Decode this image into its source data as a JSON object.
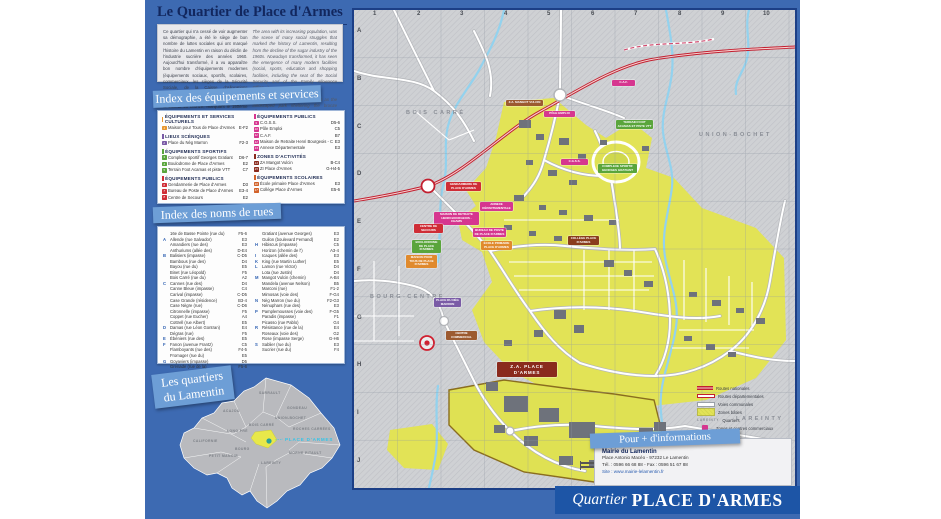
{
  "poster": {
    "title": "Le Quartier de Place d'Armes"
  },
  "intro": {
    "fr": "Ce quartier qui n'a cessé de voir augmenter sa démographie, a été le siège de bon nombre de luttes sociales qui ont marqué l'histoire du Lamentin en raison du déclin de l'industrie sucrière des années 1960. Aujourd'hui transformé, il a vu apparaître bon nombre d'équipements modernes (équipements sociaux, sportifs, scolaires, commerciaux, les sièges de la Sécurité Sociale, de la Caisse d'Allocations Familiales...). On peut y découvrir des sites tels qu'un parc paysager abritant l'Arbre de la Liberté en bronze, marquant le 150ème anniversaire de l'abolition de l'esclavage, la fresque murale du Canal Martin, un centre commercial...",
    "en1": "The area with its increasing population, was the scene of many social struggles that marked the history of Lamentin, resulting from the decline of the sugar industry of the 1960s. Nowadays transformed, it has seen the emergence of many modern facilities (social, sports, education and shopping facilities, including the seat of the Social Security and of the Family Allowance Office...).",
    "en2": "Here can be discovered such sites as the landscaped park sheltering the bronze Liberty Tree, inaugurated for the 150th anniversary of the abolition of slavery, the Canal Martin mural and a shopping centre..."
  },
  "banners": {
    "equip": "Index des équipements et services",
    "rues": "Index des noms de rues",
    "quartiers_1": "Les quartiers",
    "quartiers_2": "du Lamentin"
  },
  "equip": {
    "sections": [
      {
        "title": "ÉQUIPEMENTS ET SERVICES CULTURELS",
        "items": [
          {
            "n": "1",
            "name": "Maison pour Tous de Place d'Armes",
            "ref": "E-F2"
          }
        ]
      },
      {
        "title": "LIEUX SCÉNIQUES",
        "items": [
          {
            "n": "2",
            "name": "Place du Nèg Marron",
            "ref": "F2-3"
          }
        ]
      },
      {
        "title": "ÉQUIPEMENTS SPORTIFS",
        "items": [
          {
            "n": "3",
            "name": "Complexe sportif Georges Gratiant",
            "ref": "D6-7"
          },
          {
            "n": "4",
            "name": "Boulodrome de Place d'Armes",
            "ref": "E2"
          },
          {
            "n": "5",
            "name": "Terrain Foot Acamas et piste VTT",
            "ref": "C7"
          }
        ]
      },
      {
        "title": "ÉQUIPEMENTS PUBLICS",
        "items": [
          {
            "n": "6",
            "name": "Gendarmerie de Place d'Armes",
            "ref": "D3"
          },
          {
            "n": "7",
            "name": "Bureau de Poste de Place d'Armes",
            "ref": "E3-4"
          },
          {
            "n": "8",
            "name": "Centre de Secours",
            "ref": "E2"
          }
        ]
      },
      {
        "title": "ÉQUIPEMENTS PUBLICS",
        "items": [
          {
            "n": "9",
            "name": "C.G.S.S.",
            "ref": "D5-6"
          },
          {
            "n": "10",
            "name": "Pôle Emploi",
            "ref": "C5"
          },
          {
            "n": "11",
            "name": "C.A.F.",
            "ref": "B7"
          },
          {
            "n": "12",
            "name": "Maison de Retraite Henri Bourgeois - CHAMS",
            "ref": "E3"
          },
          {
            "n": "13",
            "name": "Annexe Départementale",
            "ref": "E3"
          }
        ]
      },
      {
        "title": "ZONES D'ACTIVITÉS",
        "items": [
          {
            "n": "14",
            "name": "ZA Mangot Vulcin",
            "ref": "B-C4"
          },
          {
            "n": "15",
            "name": "ZI Place d'Armes",
            "ref": "G-H4-5"
          }
        ]
      },
      {
        "title": "ÉQUIPEMENTS SCOLAIRES",
        "items": [
          {
            "n": "16",
            "name": "École primaire Place d'Armes",
            "ref": "E3"
          },
          {
            "n": "17",
            "name": "Collège Place d'Armes",
            "ref": "E5-6"
          }
        ]
      }
    ]
  },
  "streets": {
    "col1": [
      {
        "letter": "",
        "name": "16e de Basse Pointe (rue du)",
        "ref": "F5-6"
      },
      {
        "letter": "A",
        "name": "Allende (rue Salvador)",
        "ref": "E3"
      },
      {
        "letter": "",
        "name": "Amandiers (rue des)",
        "ref": "E3"
      },
      {
        "letter": "",
        "name": "Anthuriums (allée des)",
        "ref": "D-E4"
      },
      {
        "letter": "B",
        "name": "Balisiers (impasse)",
        "ref": "C-D5"
      },
      {
        "letter": "",
        "name": "Bambous (rue des)",
        "ref": "D4"
      },
      {
        "letter": "",
        "name": "Bayou (rue du)",
        "ref": "E5"
      },
      {
        "letter": "",
        "name": "Binet (rue Léopold)",
        "ref": "F5"
      },
      {
        "letter": "",
        "name": "Bois Carré (rue du)",
        "ref": "A2"
      },
      {
        "letter": "C",
        "name": "Cannes (rue des)",
        "ref": "D4"
      },
      {
        "letter": "",
        "name": "Canne Bleue (impasse)",
        "ref": "C4"
      },
      {
        "letter": "",
        "name": "Carival (impasse)",
        "ref": "C-D5"
      },
      {
        "letter": "",
        "name": "Case Grande (résidence)",
        "ref": "B3-4"
      },
      {
        "letter": "",
        "name": "Case Nègre (rue)",
        "ref": "C-D6"
      },
      {
        "letter": "",
        "name": "Citronnelle (impasse)",
        "ref": "F5"
      },
      {
        "letter": "",
        "name": "Coppet (rue Eucher)",
        "ref": "A4"
      },
      {
        "letter": "",
        "name": "Cottrell (rue Albert)",
        "ref": "E5"
      },
      {
        "letter": "D",
        "name": "Damas (rue Léon Gontran)",
        "ref": "E4"
      },
      {
        "letter": "",
        "name": "Dégras (rue)",
        "ref": "F5"
      },
      {
        "letter": "E",
        "name": "Ébéniers (rue des)",
        "ref": "E5"
      },
      {
        "letter": "F",
        "name": "Fanon (avenue Frantz)",
        "ref": "C5"
      },
      {
        "letter": "",
        "name": "Flamboyants (rue des)",
        "ref": "F4-5"
      },
      {
        "letter": "",
        "name": "Fromager (rue du)",
        "ref": "E5"
      },
      {
        "letter": "G",
        "name": "Goyaviers (impasse)",
        "ref": "D5"
      },
      {
        "letter": "",
        "name": "Grenade (rue de la)",
        "ref": "F5-6"
      }
    ],
    "col2": [
      {
        "letter": "",
        "name": "Gratiant (avenue Georges)",
        "ref": "E3"
      },
      {
        "letter": "",
        "name": "Guilon (boulevard Fernand)",
        "ref": "E2"
      },
      {
        "letter": "H",
        "name": "Hibiscus (impasse)",
        "ref": "C5"
      },
      {
        "letter": "",
        "name": "Horizon (chemin de l')",
        "ref": "A3-4"
      },
      {
        "letter": "I",
        "name": "Icaques (allée des)",
        "ref": "E3"
      },
      {
        "letter": "K",
        "name": "King (rue Martin Luther)",
        "ref": "E5"
      },
      {
        "letter": "L",
        "name": "Lamon (rue Victor)",
        "ref": "D4"
      },
      {
        "letter": "",
        "name": "Lota (rue Justin)",
        "ref": "D4"
      },
      {
        "letter": "M",
        "name": "Mangot Vulcin (chemin)",
        "ref": "A-B4"
      },
      {
        "letter": "",
        "name": "Mandela (avenue Nelson)",
        "ref": "B5"
      },
      {
        "letter": "",
        "name": "Marconi (rue)",
        "ref": "F1-2"
      },
      {
        "letter": "",
        "name": "Mimosas (voie des)",
        "ref": "F-G4"
      },
      {
        "letter": "N",
        "name": "Nèg Marron (rue du)",
        "ref": "F2-G3"
      },
      {
        "letter": "",
        "name": "Nénuphars (rue des)",
        "ref": "E3"
      },
      {
        "letter": "P",
        "name": "Pamplemousses (voie des)",
        "ref": "F-G5"
      },
      {
        "letter": "",
        "name": "Paradis (impasse)",
        "ref": "F1"
      },
      {
        "letter": "",
        "name": "Picasso (rue Pablo)",
        "ref": "G4"
      },
      {
        "letter": "R",
        "name": "Résistance (rue de la)",
        "ref": "E4"
      },
      {
        "letter": "",
        "name": "Roseaux (voie des)",
        "ref": "G2"
      },
      {
        "letter": "",
        "name": "Rose (impasse Serge)",
        "ref": "G-H6"
      },
      {
        "letter": "S",
        "name": "Sablier (rue du)",
        "ref": "E3"
      },
      {
        "letter": "",
        "name": "Sucrier (rue du)",
        "ref": "F4"
      }
    ]
  },
  "locator": {
    "highlight": "PLACE D'ARMES",
    "labels": [
      "SARRAULT",
      "GONDEAU",
      "ACAJOU",
      "BOIS CARRÉ",
      "ROCHES CARRÉES",
      "UNION-BOCHET",
      "MORNE PITAULT",
      "LAREINTY",
      "BOURG",
      "CALIFORNIE",
      "PETIT MANOIR",
      "LONG PRÉ"
    ]
  },
  "map": {
    "grid_cols": [
      "1",
      "2",
      "3",
      "4",
      "5",
      "6",
      "7",
      "8",
      "9",
      "10"
    ],
    "grid_rows": [
      "A",
      "B",
      "C",
      "D",
      "E",
      "F",
      "G",
      "H",
      "I",
      "J"
    ],
    "compass_n": "N",
    "districts": [
      "BOIS CARRÉ",
      "UNION-BOCHET",
      "BOURG-CENTRE",
      "LAREINTY"
    ],
    "pois": [
      {
        "label": "Z.A. MANGOT VULCIN",
        "color": "#9c5a30"
      },
      {
        "label": "PÔLE EMPLOI",
        "color": "#d6368f"
      },
      {
        "label": "C.A.F.",
        "color": "#d6368f"
      },
      {
        "label": "C.G.S.S.",
        "color": "#d6368f"
      },
      {
        "label": "TERRAIN FOOT ACAMAS ET PISTE VTT",
        "color": "#5aa53c"
      },
      {
        "label": "COMPLEXE SPORTIF GEORGES GRATIANT",
        "color": "#5aa53c"
      },
      {
        "label": "GENDARMERIE DE PLACE D'ARMES",
        "color": "#cf2d36"
      },
      {
        "label": "MAISON DE RETRAITE HENRI BOURGEOIS - CHAMS",
        "color": "#d6368f"
      },
      {
        "label": "ANNEXE DÉPARTEMENTALE",
        "color": "#d6368f"
      },
      {
        "label": "CENTRE DE SECOURS",
        "color": "#cf2d36"
      },
      {
        "label": "BUREAU DE POSTE DE PLACE D'ARMES",
        "color": "#d6368f"
      },
      {
        "label": "ÉCOLE PRIMAIRE PLACE D'ARMES",
        "color": "#e08a2d"
      },
      {
        "label": "BOULODROME DE PLACE D'ARMES",
        "color": "#5aa53c"
      },
      {
        "label": "MAISON POUR TOUS DE PLACE D'ARMES",
        "color": "#e08a2d"
      },
      {
        "label": "COLLÈGE PLACE D'ARMES",
        "color": "#8a3d1e"
      },
      {
        "label": "PLACE DU NÈG MARRON",
        "color": "#7a5ba6"
      },
      {
        "label": "CENTRE COMMERCIAL",
        "color": "#9c5a30"
      },
      {
        "label": "Z.A. PLACE D'ARMES",
        "color": "#8a2a1d"
      }
    ],
    "legend": [
      {
        "label": "Routes nationales"
      },
      {
        "label": "Routes départementales"
      },
      {
        "label": "Voies communales"
      },
      {
        "label": "Zones bâties"
      },
      {
        "label": "Quartiers",
        "sample": "LAREINTY"
      },
      {
        "label": "Zones et centres commerciaux"
      }
    ],
    "scale_labels": [
      "250 m",
      "500 m"
    ]
  },
  "info": {
    "banner": "Pour + d'informations",
    "name": "Mairie du Lamentin",
    "address": "Place Antonio Macéo - 97232 Le Lamentin",
    "phone": "Tél. : 0596 66 68 88 - Fax : 0596 51 67 88",
    "site": "Site : www.mairie-lelamentin.fr"
  },
  "footer": {
    "prefix": "Quartier",
    "title": "PLACE D'ARMES"
  },
  "colors": {
    "poster_blue": "#3d6ab2",
    "banner_blue": "#6d9ed6",
    "footer_blue": "#1d55a6",
    "map_gray": "#cfd1d4",
    "urban_yellow": "#e2e356",
    "water_cyan": "#93d2ee",
    "route_nationale_red": "#c21f2f",
    "poi_magenta": "#d6368f",
    "poi_green": "#5aa53c",
    "poi_red": "#cf2d36"
  }
}
